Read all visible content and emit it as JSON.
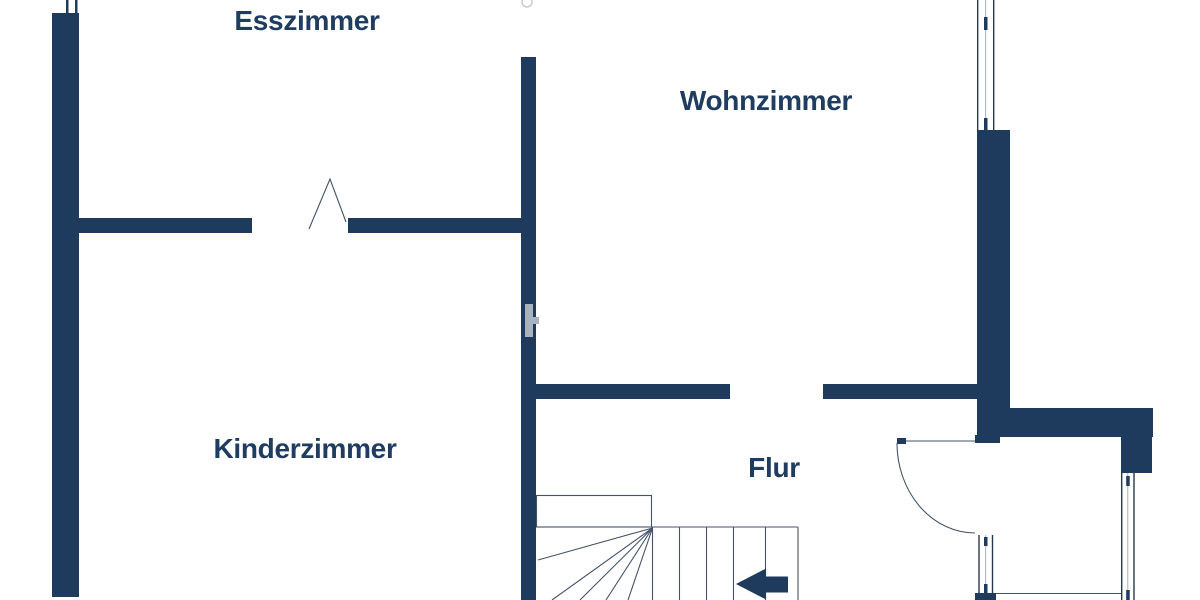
{
  "document": {
    "kind": "floor-plan",
    "language": "de"
  },
  "rooms": [
    {
      "id": "esszimmer",
      "label": "Esszimmer"
    },
    {
      "id": "wohnzimmer",
      "label": "Wohnzimmer"
    },
    {
      "id": "kinderzimmer",
      "label": "Kinderzimmer"
    },
    {
      "id": "flur",
      "label": "Flur"
    }
  ],
  "symbols": {
    "doors": [
      {
        "name": "door-swing-esszimmer",
        "style": "folding-leaf-lines"
      },
      {
        "name": "door-swing-flur-right",
        "style": "quarter-circle-arc"
      }
    ],
    "windows": [
      {
        "name": "window-wohnzimmer-top-right"
      },
      {
        "name": "window-bottom-center"
      },
      {
        "name": "window-right-side"
      }
    ],
    "stairs": {
      "name": "staircase-with-winder-treads",
      "direction_arrow": "left",
      "tread_lines": 6
    },
    "watermark": {
      "name": "watermark-letter-h"
    }
  },
  "colors": {
    "wall": "#1e3a5c",
    "label_text": "#1f3d61",
    "thin_line": "#44536a",
    "frame_line": "#24384f",
    "center_line": "#9aa4b2",
    "watermark": "#a9b3c0",
    "background": "#ffffff"
  }
}
